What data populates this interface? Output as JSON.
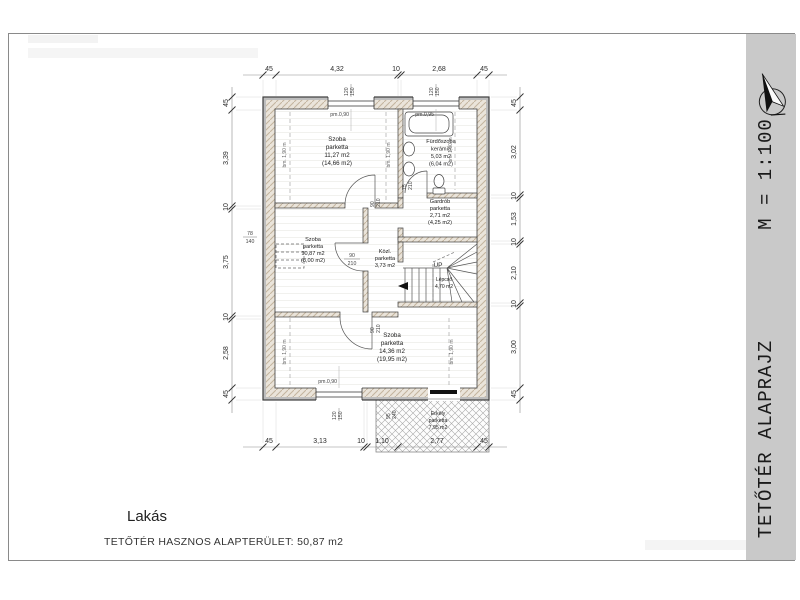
{
  "title_block": {
    "title": "TETŐTÉR ALAPRAJZ",
    "scale": "M = 1:100",
    "bg": "#c9c9c9"
  },
  "footer": {
    "name": "Lakás",
    "area_label": "TETŐTÉR HASZNOS ALAPTERÜLET:",
    "area_value": "50,87 m2"
  },
  "rooms": [
    {
      "name": "Szoba",
      "finish": "parketta",
      "area": "11,27 m2",
      "gross": "(14,66 m2)"
    },
    {
      "name": "Fürdőszoba",
      "finish": "kerámia",
      "area": "5,03 m2",
      "gross": "(6,04 m2)"
    },
    {
      "name": "Gardrób",
      "finish": "parketta",
      "area": "2,71 m2",
      "gross": "(4,25 m2)"
    },
    {
      "name": "Szoba",
      "finish": "parketta",
      "area": "10,87 m2",
      "gross": "(8,00 m2)"
    },
    {
      "name": "Közl.",
      "finish": "parketta",
      "area": "3,73 m2",
      "gross": ""
    },
    {
      "name": "Lépcső",
      "finish": "",
      "area": "4,70 m2",
      "gross": ""
    },
    {
      "name": "Szoba",
      "finish": "parketta",
      "area": "14,36 m2",
      "gross": "(19,95 m2)"
    },
    {
      "name": "Erkély",
      "finish": "parketta",
      "area": "7,95 m2",
      "gross": ""
    }
  ],
  "stairs": {
    "up_label": "UP"
  },
  "dims": {
    "top": [
      "45",
      "4,32",
      "10",
      "2,68",
      "45"
    ],
    "bottom": [
      "45",
      "3,13",
      "10",
      "1,10",
      "2,77",
      "45"
    ],
    "left": [
      "45",
      "3,39",
      "10",
      "3,75",
      "10",
      "2,58",
      "45"
    ],
    "right": [
      "45",
      "3,02",
      "10",
      "1,53",
      "10",
      "2,10",
      "10",
      "3,00",
      "45"
    ]
  },
  "openings": {
    "window_top_1": {
      "w": "120",
      "h": "150",
      "parapet": "pm.0,90"
    },
    "window_top_2": {
      "w": "120",
      "h": "150",
      "parapet": "pm.0,95"
    },
    "window_bottom": {
      "w": "120",
      "h": "150",
      "parapet": "pm.0,90"
    },
    "roof_window": {
      "w": "78",
      "h": "140"
    },
    "balcony_door": {
      "w": "95",
      "h": "240"
    },
    "door_top_room": {
      "w": "90",
      "h": "210"
    },
    "door_bath": {
      "w": "75",
      "h": "210"
    },
    "door_left_room": {
      "w": "90",
      "h": "210"
    },
    "door_bottom_room": {
      "w": "90",
      "h": "210"
    },
    "knee_wall_label": "bm. 1,90 m"
  }
}
